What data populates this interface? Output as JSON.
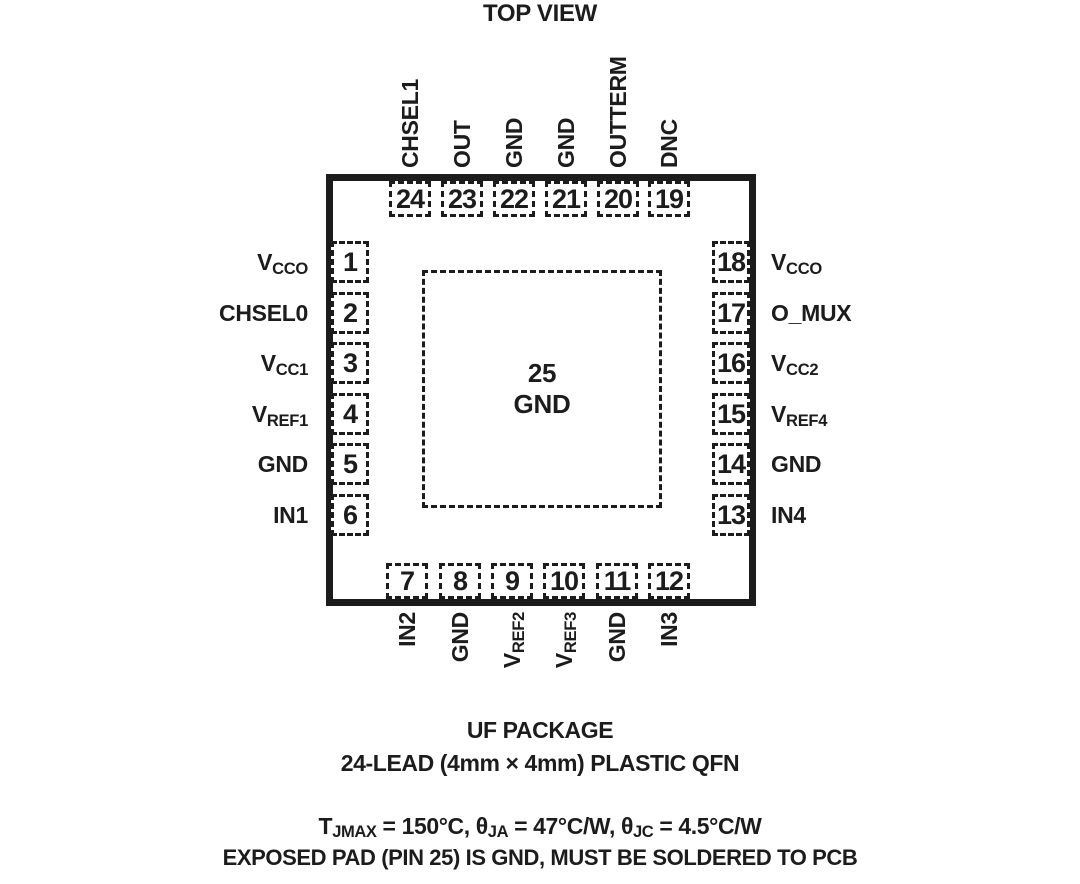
{
  "title": "TOP VIEW",
  "colors": {
    "ink": "#1c1c1c",
    "background": "#ffffff"
  },
  "chip": {
    "center_pad": {
      "number": "25",
      "label": "GND"
    },
    "pins": {
      "top": [
        {
          "num": "24",
          "main": "CHSEL1",
          "sub": ""
        },
        {
          "num": "23",
          "main": "OUT",
          "sub": ""
        },
        {
          "num": "22",
          "main": "GND",
          "sub": ""
        },
        {
          "num": "21",
          "main": "GND",
          "sub": ""
        },
        {
          "num": "20",
          "main": "OUTTERM",
          "sub": ""
        },
        {
          "num": "19",
          "main": "DNC",
          "sub": ""
        }
      ],
      "left": [
        {
          "num": "1",
          "main": "V",
          "sub": "CCO"
        },
        {
          "num": "2",
          "main": "CHSEL0",
          "sub": ""
        },
        {
          "num": "3",
          "main": "V",
          "sub": "CC1"
        },
        {
          "num": "4",
          "main": "V",
          "sub": "REF1"
        },
        {
          "num": "5",
          "main": "GND",
          "sub": ""
        },
        {
          "num": "6",
          "main": "IN1",
          "sub": ""
        }
      ],
      "right": [
        {
          "num": "18",
          "main": "V",
          "sub": "CCO"
        },
        {
          "num": "17",
          "main": "O_MUX",
          "sub": ""
        },
        {
          "num": "16",
          "main": "V",
          "sub": "CC2"
        },
        {
          "num": "15",
          "main": "V",
          "sub": "REF4"
        },
        {
          "num": "14",
          "main": "GND",
          "sub": ""
        },
        {
          "num": "13",
          "main": "IN4",
          "sub": ""
        }
      ],
      "bottom": [
        {
          "num": "7",
          "main": "IN2",
          "sub": ""
        },
        {
          "num": "8",
          "main": "GND",
          "sub": ""
        },
        {
          "num": "9",
          "main": "V",
          "sub": "REF2"
        },
        {
          "num": "10",
          "main": "V",
          "sub": "REF3"
        },
        {
          "num": "11",
          "main": "GND",
          "sub": ""
        },
        {
          "num": "12",
          "main": "IN3",
          "sub": ""
        }
      ]
    }
  },
  "footer": {
    "package_line1": "UF PACKAGE",
    "package_line2": "24-LEAD (4mm × 4mm) PLASTIC QFN",
    "thermal": {
      "p0": "T",
      "s0": "JMAX",
      "p1": " = 150°C, θ",
      "s1": "JA",
      "p2": " = 47°C/W, θ",
      "s2": "JC",
      "p3": " = 4.5°C/W"
    },
    "note_line": "EXPOSED PAD (PIN 25) IS GND, MUST BE SOLDERED TO PCB"
  }
}
